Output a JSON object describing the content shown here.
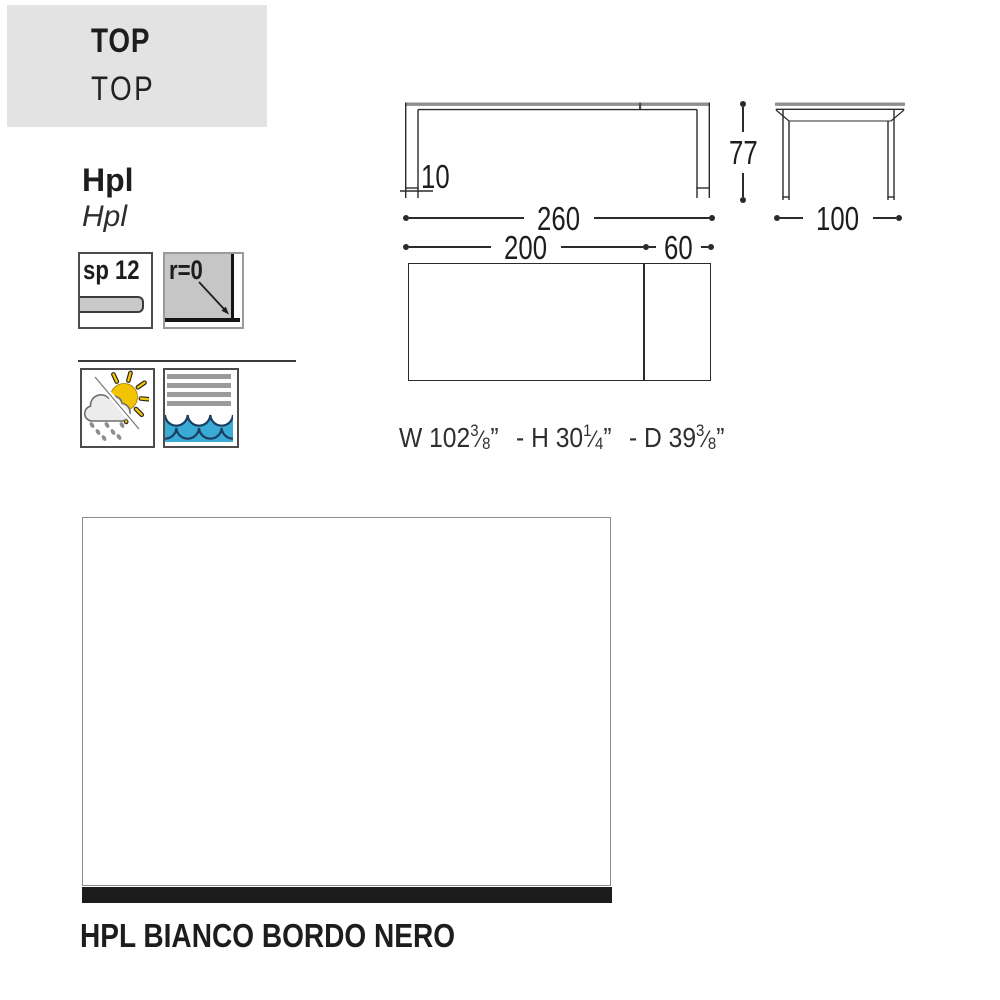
{
  "header": {
    "title": "TOP",
    "subtitle": "TOP"
  },
  "material": {
    "name": "Hpl",
    "name_italic": "Hpl"
  },
  "specs": {
    "thickness_label": "sp 12",
    "radius_label": "r=0"
  },
  "icons": {
    "thickness": "panel-thickness-icon",
    "radius": "corner-radius-icon",
    "weather": "sun-cloud-rain-icon",
    "marine": "waves-icon"
  },
  "dimensions": {
    "front_view": {
      "width": "260",
      "leg": "10"
    },
    "side_view": {
      "height": "77",
      "depth": "100"
    },
    "top_view": {
      "length": "200",
      "extension": "60"
    }
  },
  "imperial": {
    "parts": [
      {
        "prefix": "W 102",
        "num": "3",
        "den": "8",
        "inch": "”"
      },
      {
        "prefix": "- H 30",
        "num": "1",
        "den": "4",
        "inch": "”"
      },
      {
        "prefix": "- D 39",
        "num": "3",
        "den": "8",
        "inch": "”"
      }
    ]
  },
  "finish": {
    "label": "HPL BIANCO BORDO NERO"
  },
  "colors": {
    "header_bg": "#e3e3e3",
    "line": "#2b2b2b",
    "wave_blue": "#39abd4",
    "sun_yellow": "#f3c402",
    "swatch_edge_black": "#1c1c1c"
  }
}
